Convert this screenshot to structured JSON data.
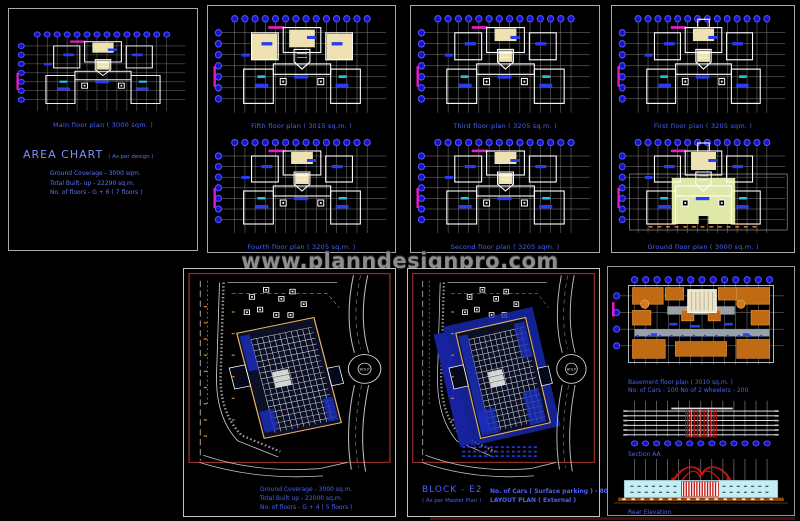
{
  "watermark": "www.planndesignpro.com",
  "colors": {
    "caption_blue": "#4a63f2",
    "bubble_fill": "#1414c8",
    "bubble_stroke": "#5050ff",
    "grid_gray": "#8d8d8d",
    "wall_white": "#ffffff",
    "cad_magenta": "#e21ec8",
    "cream": "#eee2b2",
    "ground_fill": "#dfe8a6",
    "site_border_red": "#93302a",
    "building_edge_orange": "#e8b264",
    "landscape_blue": "#1a2ec0",
    "basement_orange": "#c06a14",
    "elevation_red": "#c41414",
    "elevation_cyan": "#c2eef4",
    "base_brown": "#8a4812"
  },
  "panels": {
    "main": {
      "caption": "Main floor plan ( 3000 sqm. )",
      "area_chart": {
        "title": "AREA CHART",
        "suffix": "( As per design )",
        "line1": "Ground Coverage - 3000 sqm.",
        "line2": "Total Built- up - 22290 sq.m.",
        "line3": "No. of floors - G + 6 ( 7 floors )"
      }
    },
    "fifth": {
      "caption": "Fifth floor plan ( 3015 sq.m. )"
    },
    "fourth": {
      "caption": "Fourth floor plan ( 3205 sq.m. )"
    },
    "third": {
      "caption": "Third floor plan ( 3205 sq.m. )"
    },
    "second": {
      "caption": "Second floor plan ( 3205 sqm. )"
    },
    "first": {
      "caption": "First floor plan ( 3205 sqm. )"
    },
    "ground": {
      "caption": "Ground floor plan ( 3000 sq.m. )"
    },
    "site_left": {
      "line1": "Ground Coverage - 3000 sq.m.",
      "line2": "Total Built up - 22000 sq.m.",
      "line3": "No. of floors - G + 4 ( 5 floors )",
      "roundabout": "BOLP"
    },
    "site_right": {
      "block": "BLOCK - E2",
      "block_sub": "( As per Master Plan )",
      "info1": "No. of Cars ( Surface parking ) - 80",
      "info2": "LAYOUT PLAN ( External )",
      "roundabout": "BOLP"
    },
    "details": {
      "basement_caption": "Basement floor plan ( 3010 sq.m. )",
      "basement_info": "No. of Cars - 100    No of 2 wheelers - 200",
      "section_caption": "Section AA",
      "elevation_caption": "Rear Elevation"
    }
  }
}
